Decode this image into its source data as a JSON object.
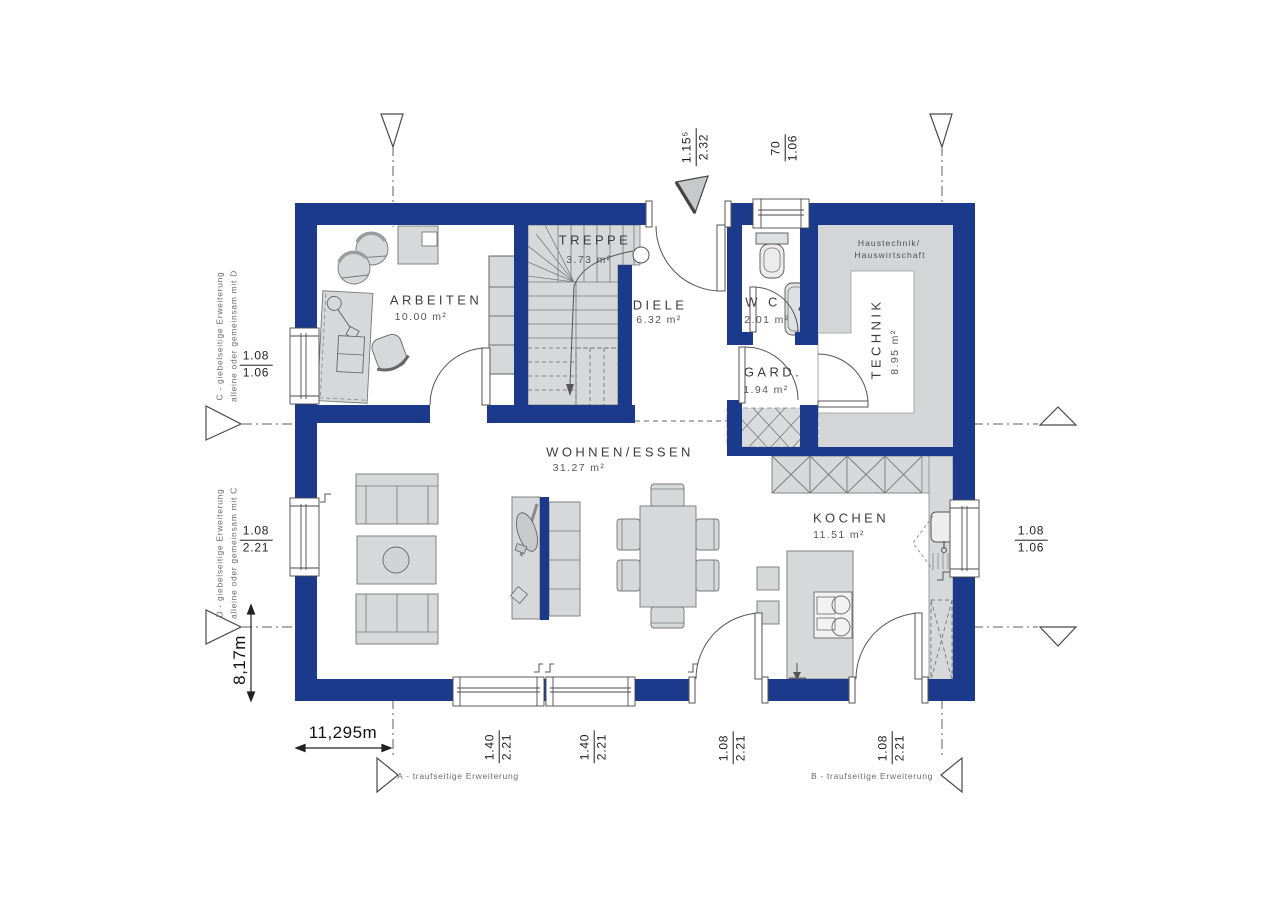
{
  "page": {
    "background": "#ffffff"
  },
  "colors": {
    "wall": "#1b3a8c",
    "furniture_fill": "#d7d8d9",
    "room_fill": "#ffffff",
    "line": "#4a4a4a",
    "text": "#3d3d3d",
    "muted_text": "#6b6b6b"
  },
  "rooms": {
    "arbeiten": {
      "label": "ARBEITEN",
      "area": "10.00 m²"
    },
    "treppe": {
      "label": "TREPPE",
      "area": "3.73 m²"
    },
    "diele": {
      "label": "DIELE",
      "area": "6.32 m²"
    },
    "wc": {
      "label": "W C",
      "area": "2.01 m²"
    },
    "gard": {
      "label": "GARD.",
      "area": "1.94 m²"
    },
    "technik": {
      "label": "TECHNIK",
      "area": "8.95 m²",
      "note_line1": "Haustechnik/",
      "note_line2": "Hauswirtschaft"
    },
    "wohnen": {
      "label": "WOHNEN/ESSEN",
      "area": "31.27 m²"
    },
    "kochen": {
      "label": "KOCHEN",
      "area": "11.51 m²"
    }
  },
  "dimensions": {
    "entrance_door": {
      "num": "1.15⁵",
      "den": "2.32"
    },
    "wc_window": {
      "num": "70",
      "den": "1.06"
    },
    "arbeiten_window": {
      "num": "1.08",
      "den": "1.06"
    },
    "wohnen_side_window": {
      "num": "1.08",
      "den": "2.21"
    },
    "kochen_window": {
      "num": "1.08",
      "den": "1.06"
    },
    "terrace_window_1": {
      "num": "1.40",
      "den": "2.21"
    },
    "terrace_window_2": {
      "num": "1.40",
      "den": "2.21"
    },
    "terrace_door_1": {
      "num": "1.08",
      "den": "2.21"
    },
    "terrace_door_2": {
      "num": "1.08",
      "den": "2.21"
    },
    "overall_width": "11,295m",
    "overall_height": "8,17m"
  },
  "extensions": {
    "a": "A - traufseitige Erweiterung",
    "b": "B - traufseitige Erweiterung",
    "c_line1": "C - giebelseitige Erweiterung",
    "c_line2": "alleine oder gemeinsam mit D",
    "d_line1": "D - giebelseitige Erweiterung",
    "d_line2": "alleine oder gemeinsam mit C"
  }
}
